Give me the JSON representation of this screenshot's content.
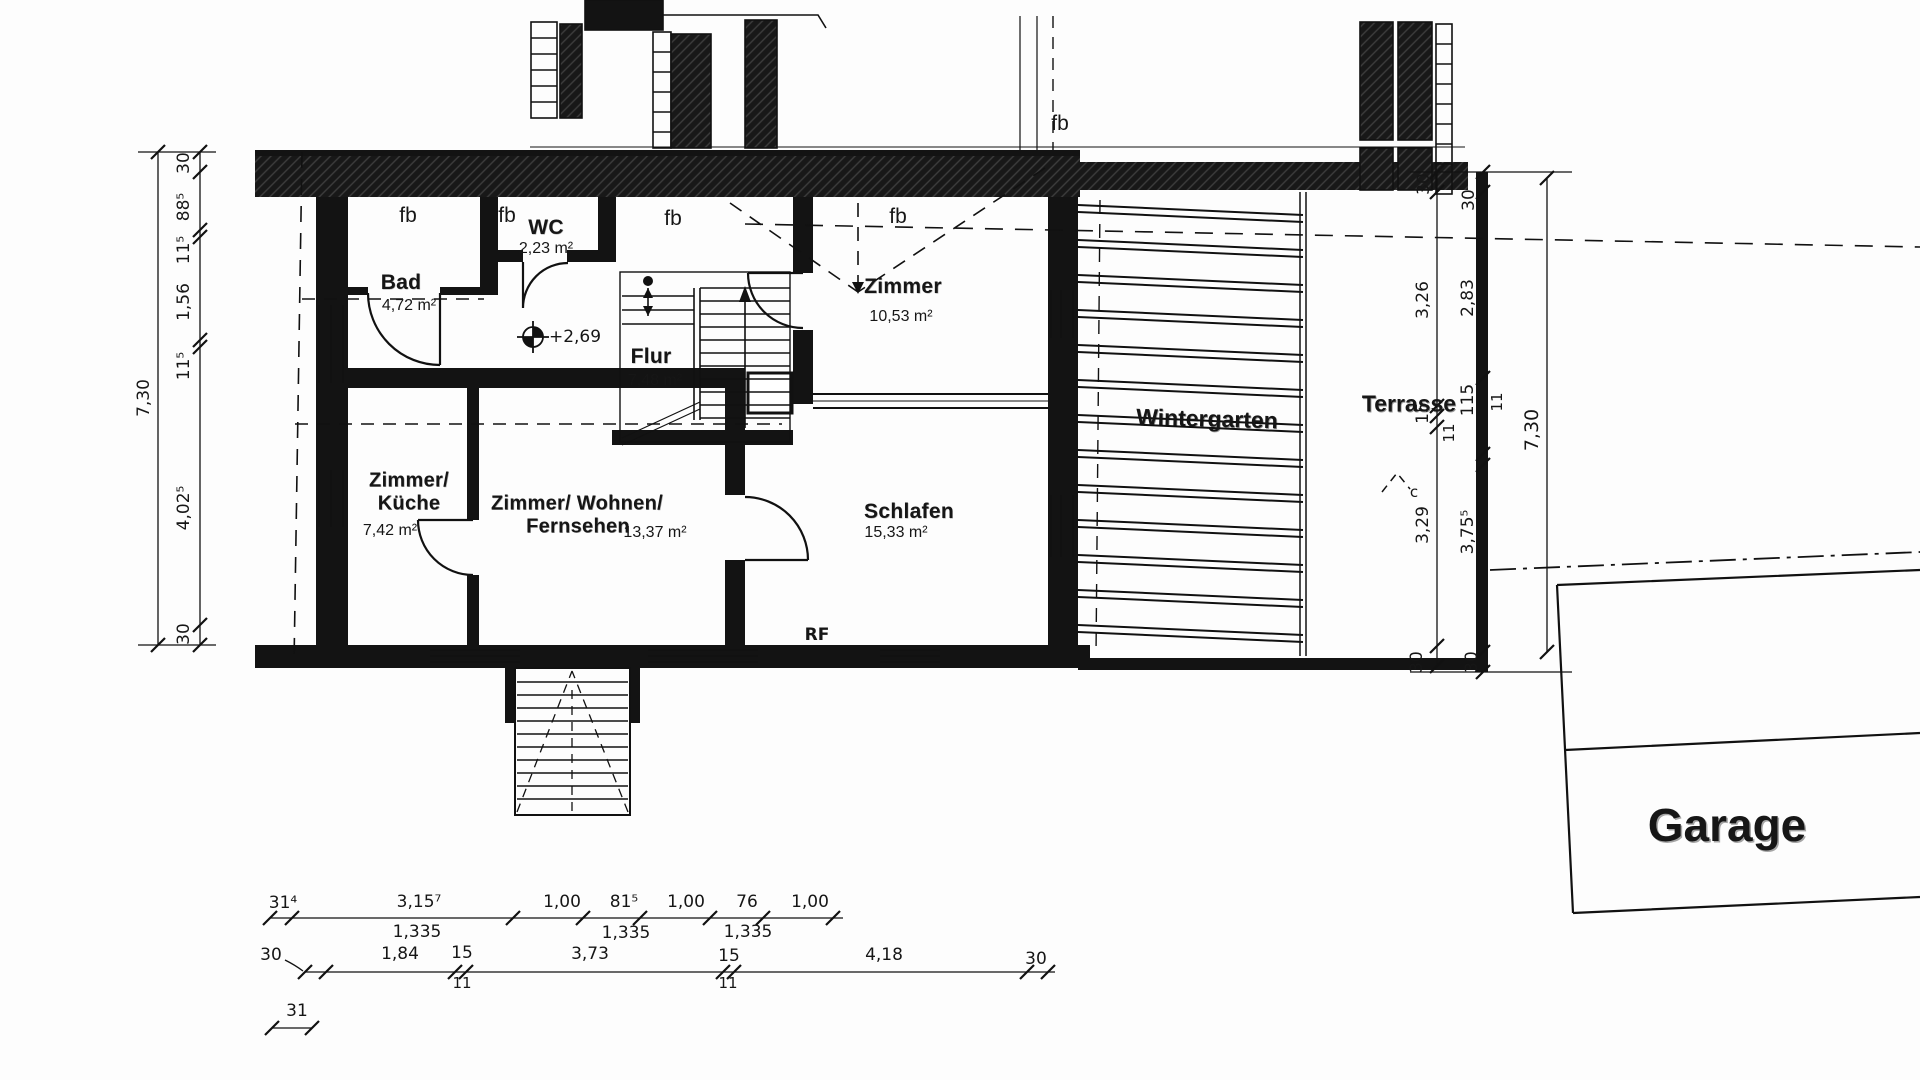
{
  "plan_title": "Grundriss Obergeschoss",
  "annotations": {
    "fb": "fb",
    "level_mark": "+2,69",
    "rf": "RF",
    "c_mark": "c"
  },
  "rooms": {
    "bad": {
      "name": "Bad",
      "area": "4,72 m²"
    },
    "wc": {
      "name": "WC",
      "area": "2,23 m²"
    },
    "flur": {
      "name": "Flur",
      "area": "7,48 m²"
    },
    "zimmer": {
      "name": "Zimmer",
      "area": "10,53 m²"
    },
    "kueche": {
      "name_line1": "Zimmer/",
      "name_line2": "Küche",
      "area": "7,42 m²"
    },
    "wohnen": {
      "name_line1": "Zimmer/ Wohnen/",
      "name_line2": "Fernsehen",
      "area": "13,37 m²"
    },
    "schlafen": {
      "name": "Schlafen",
      "area": "15,33 m²"
    },
    "wintergarten": {
      "name": "Wintergarten"
    },
    "terrasse": {
      "name": "Terrasse"
    },
    "garage": {
      "name": "Garage"
    }
  },
  "dimensions": {
    "left_outer_total": "7,30",
    "left_inner": [
      "30",
      "88⁵",
      "11⁵",
      "1,56",
      "11⁵",
      "4,02⁵",
      "30"
    ],
    "right_inner": [
      "30",
      "3,26",
      "15",
      "11",
      "3,29",
      "30"
    ],
    "right_middle": [
      "30",
      "2,83",
      "115",
      "11",
      "3,75⁵",
      "30"
    ],
    "right_outer_total": "7,30",
    "bottom_window_chain": [
      "31⁴",
      "3,15⁷",
      "1,00",
      "81⁵",
      "1,00",
      "76",
      "1,00"
    ],
    "bottom_sill_labels": [
      "1,335",
      "1,335",
      "1,335"
    ],
    "bottom_main_chain": [
      "30",
      "1,84",
      "15",
      "3,73",
      "15",
      "4,18",
      "30"
    ],
    "bottom_wall_sub": [
      "11",
      "11"
    ],
    "bottom_left_offset": "31"
  },
  "colors": {
    "ink": "#111111",
    "paper": "#fdfdfd"
  }
}
